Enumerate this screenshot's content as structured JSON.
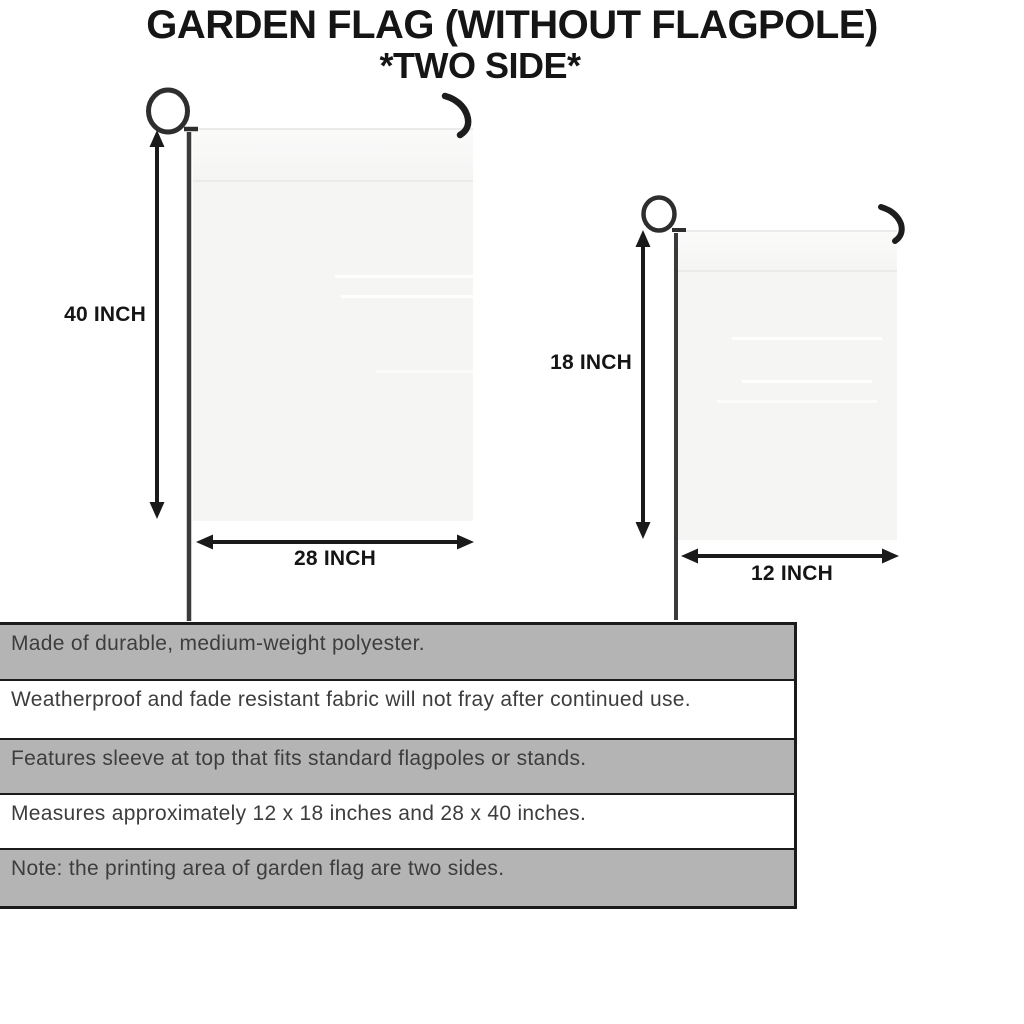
{
  "title": {
    "line1": "GARDEN FLAG (WITHOUT FLAGPOLE)",
    "line2": "*TWO SIDE*"
  },
  "flags": {
    "large": {
      "height_label": "40 INCH",
      "width_label": "28 INCH"
    },
    "small": {
      "height_label": "18 INCH",
      "width_label": "12 INCH"
    }
  },
  "features": {
    "rows": [
      {
        "text": "Made of durable, medium-weight polyester.",
        "shaded": true
      },
      {
        "text": "Weatherproof and fade resistant fabric will not fray after continued use.",
        "shaded": false
      },
      {
        "text": "Features sleeve at top that fits standard flagpoles or stands.",
        "shaded": true
      },
      {
        "text": "Measures approximately 12 x 18 inches and 28 x 40 inches.",
        "shaded": false
      },
      {
        "text": "Note: the printing area of garden flag are two sides.",
        "shaded": true
      }
    ]
  },
  "colors": {
    "ink": "#151515",
    "text": "#3d3d3d",
    "border": "#1b1b1b",
    "row_shaded": "#b4b4b4",
    "row_plain": "#ffffff",
    "flag_fill": "#f5f5f4",
    "pole": "#3a3a3a"
  }
}
